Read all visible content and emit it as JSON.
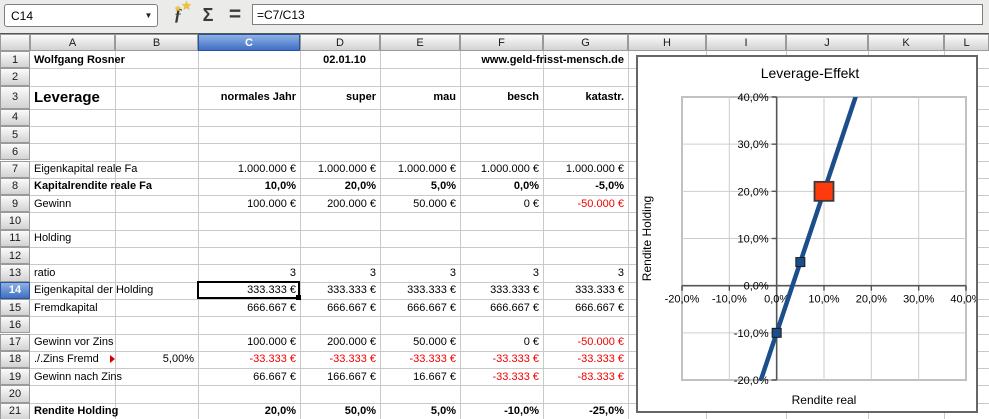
{
  "toolbar": {
    "cell_reference": "C14",
    "formula": "=C7/C13",
    "dropdown_glyph": "▼",
    "function_wizard_glyph": "ƒ",
    "star_glyph": "★",
    "sum_glyph": "Σ",
    "equals_glyph": "="
  },
  "sheet": {
    "columns": [
      "A",
      "B",
      "C",
      "D",
      "E",
      "F",
      "G",
      "H",
      "I",
      "J",
      "K",
      "L"
    ],
    "row_numbers": [
      1,
      2,
      3,
      4,
      5,
      6,
      7,
      8,
      9,
      10,
      11,
      12,
      13,
      14,
      15,
      16,
      17,
      18,
      19,
      20,
      21
    ],
    "selected_column": "C",
    "selected_row": 14,
    "selected_cell": "C14",
    "rows": [
      {
        "n": 1,
        "cells": [
          {
            "c": "A",
            "t": "Wolfgang Rosner",
            "b": 1,
            "al": "l",
            "span": 2
          },
          {
            "c": "D",
            "t": "02.01.10",
            "b": 1,
            "al": "r",
            "pad": 14
          },
          {
            "c": "E",
            "t": "www.geld-frisst-mensch.de",
            "b": 1,
            "al": "r",
            "span": 3
          }
        ]
      },
      {
        "n": 3,
        "cells": [
          {
            "c": "A",
            "t": "Leverage",
            "b": 1,
            "al": "l",
            "size": 15,
            "span": 2
          },
          {
            "c": "C",
            "t": "normales Jahr",
            "b": 1,
            "al": "r"
          },
          {
            "c": "D",
            "t": "super",
            "b": 1,
            "al": "r"
          },
          {
            "c": "E",
            "t": "mau",
            "b": 1,
            "al": "r"
          },
          {
            "c": "F",
            "t": "besch",
            "b": 1,
            "al": "r"
          },
          {
            "c": "G",
            "t": "katastr.",
            "b": 1,
            "al": "r"
          }
        ]
      },
      {
        "n": 7,
        "cells": [
          {
            "c": "A",
            "t": "Eigenkapital reale Fa",
            "al": "l"
          },
          {
            "c": "C",
            "t": "1.000.000 €",
            "al": "r"
          },
          {
            "c": "D",
            "t": "1.000.000 €",
            "al": "r"
          },
          {
            "c": "E",
            "t": "1.000.000 €",
            "al": "r"
          },
          {
            "c": "F",
            "t": "1.000.000 €",
            "al": "r"
          },
          {
            "c": "G",
            "t": "1.000.000 €",
            "al": "r"
          }
        ]
      },
      {
        "n": 8,
        "cells": [
          {
            "c": "A",
            "t": "Kapitalrendite reale Fa",
            "b": 1,
            "al": "l"
          },
          {
            "c": "C",
            "t": "10,0%",
            "b": 1,
            "al": "r"
          },
          {
            "c": "D",
            "t": "20,0%",
            "b": 1,
            "al": "r"
          },
          {
            "c": "E",
            "t": "5,0%",
            "b": 1,
            "al": "r"
          },
          {
            "c": "F",
            "t": "0,0%",
            "b": 1,
            "al": "r"
          },
          {
            "c": "G",
            "t": "-5,0%",
            "b": 1,
            "al": "r"
          }
        ]
      },
      {
        "n": 9,
        "cells": [
          {
            "c": "A",
            "t": "Gewinn",
            "al": "l"
          },
          {
            "c": "C",
            "t": "100.000 €",
            "al": "r"
          },
          {
            "c": "D",
            "t": "200.000 €",
            "al": "r"
          },
          {
            "c": "E",
            "t": "50.000 €",
            "al": "r"
          },
          {
            "c": "F",
            "t": "0 €",
            "al": "r"
          },
          {
            "c": "G",
            "t": "-50.000 €",
            "al": "r",
            "red": 1
          }
        ]
      },
      {
        "n": 11,
        "cells": [
          {
            "c": "A",
            "t": "Holding",
            "al": "l"
          }
        ]
      },
      {
        "n": 13,
        "cells": [
          {
            "c": "A",
            "t": "ratio",
            "al": "l"
          },
          {
            "c": "C",
            "t": "3",
            "al": "r"
          },
          {
            "c": "D",
            "t": "3",
            "al": "r"
          },
          {
            "c": "E",
            "t": "3",
            "al": "r"
          },
          {
            "c": "F",
            "t": "3",
            "al": "r"
          },
          {
            "c": "G",
            "t": "3",
            "al": "r"
          }
        ]
      },
      {
        "n": 14,
        "cells": [
          {
            "c": "A",
            "t": "Eigenkapital der Holding",
            "al": "l"
          },
          {
            "c": "C",
            "t": "333.333 €",
            "al": "r"
          },
          {
            "c": "D",
            "t": "333.333 €",
            "al": "r"
          },
          {
            "c": "E",
            "t": "333.333 €",
            "al": "r"
          },
          {
            "c": "F",
            "t": "333.333 €",
            "al": "r"
          },
          {
            "c": "G",
            "t": "333.333 €",
            "al": "r"
          }
        ]
      },
      {
        "n": 15,
        "cells": [
          {
            "c": "A",
            "t": "Fremdkapital",
            "al": "l"
          },
          {
            "c": "C",
            "t": "666.667 €",
            "al": "r"
          },
          {
            "c": "D",
            "t": "666.667 €",
            "al": "r"
          },
          {
            "c": "E",
            "t": "666.667 €",
            "al": "r"
          },
          {
            "c": "F",
            "t": "666.667 €",
            "al": "r"
          },
          {
            "c": "G",
            "t": "666.667 €",
            "al": "r"
          }
        ]
      },
      {
        "n": 17,
        "cells": [
          {
            "c": "A",
            "t": "Gewinn vor Zins",
            "al": "l"
          },
          {
            "c": "C",
            "t": "100.000 €",
            "al": "r"
          },
          {
            "c": "D",
            "t": "200.000 €",
            "al": "r"
          },
          {
            "c": "E",
            "t": "50.000 €",
            "al": "r"
          },
          {
            "c": "F",
            "t": "0 €",
            "al": "r"
          },
          {
            "c": "G",
            "t": "-50.000 €",
            "al": "r",
            "red": 1
          }
        ]
      },
      {
        "n": 18,
        "cells": [
          {
            "c": "A",
            "t": "./.Zins Fremd",
            "al": "l",
            "clip": 1,
            "ovf": 1
          },
          {
            "c": "B",
            "t": "5,00%",
            "al": "r"
          },
          {
            "c": "C",
            "t": "-33.333 €",
            "al": "r",
            "red": 1
          },
          {
            "c": "D",
            "t": "-33.333 €",
            "al": "r",
            "red": 1
          },
          {
            "c": "E",
            "t": "-33.333 €",
            "al": "r",
            "red": 1
          },
          {
            "c": "F",
            "t": "-33.333 €",
            "al": "r",
            "red": 1
          },
          {
            "c": "G",
            "t": "-33.333 €",
            "al": "r",
            "red": 1
          }
        ]
      },
      {
        "n": 19,
        "cells": [
          {
            "c": "A",
            "t": "Gewinn nach Zins",
            "al": "l"
          },
          {
            "c": "C",
            "t": "66.667 €",
            "al": "r"
          },
          {
            "c": "D",
            "t": "166.667 €",
            "al": "r"
          },
          {
            "c": "E",
            "t": "16.667 €",
            "al": "r"
          },
          {
            "c": "F",
            "t": "-33.333 €",
            "al": "r",
            "red": 1
          },
          {
            "c": "G",
            "t": "-83.333 €",
            "al": "r",
            "red": 1
          }
        ]
      },
      {
        "n": 21,
        "cells": [
          {
            "c": "A",
            "t": "Rendite Holding",
            "b": 1,
            "al": "l"
          },
          {
            "c": "C",
            "t": "20,0%",
            "b": 1,
            "al": "r"
          },
          {
            "c": "D",
            "t": "50,0%",
            "b": 1,
            "al": "r"
          },
          {
            "c": "E",
            "t": "5,0%",
            "b": 1,
            "al": "r"
          },
          {
            "c": "F",
            "t": "-10,0%",
            "b": 1,
            "al": "r"
          },
          {
            "c": "G",
            "t": "-25,0%",
            "b": 1,
            "al": "r"
          }
        ]
      }
    ]
  },
  "chart_data": {
    "type": "line",
    "title": "Leverage-Effekt",
    "xlabel": "Rendite real",
    "ylabel": "Rendite Holding",
    "xlim": [
      -20,
      40
    ],
    "ylim": [
      -20,
      40
    ],
    "x_ticks": [
      "-20,0%",
      "-10,0%",
      "0,0%",
      "10,0%",
      "20,0%",
      "30,0%",
      "40,0%"
    ],
    "y_ticks": [
      "40,0%",
      "30,0%",
      "20,0%",
      "10,0%",
      "0,0%",
      "-10,0%",
      "-20,0%"
    ],
    "grid": true,
    "line_color": "#1c4e8c",
    "highlight_color": "#fd3b0d",
    "series": [
      {
        "name": "Rendite Holding",
        "points": [
          [
            -5,
            -25
          ],
          [
            0,
            -10
          ],
          [
            5,
            5
          ],
          [
            10,
            20
          ],
          [
            20,
            50
          ]
        ]
      },
      {
        "name": "normales Jahr highlight",
        "points": [
          [
            10,
            20
          ]
        ]
      }
    ]
  }
}
